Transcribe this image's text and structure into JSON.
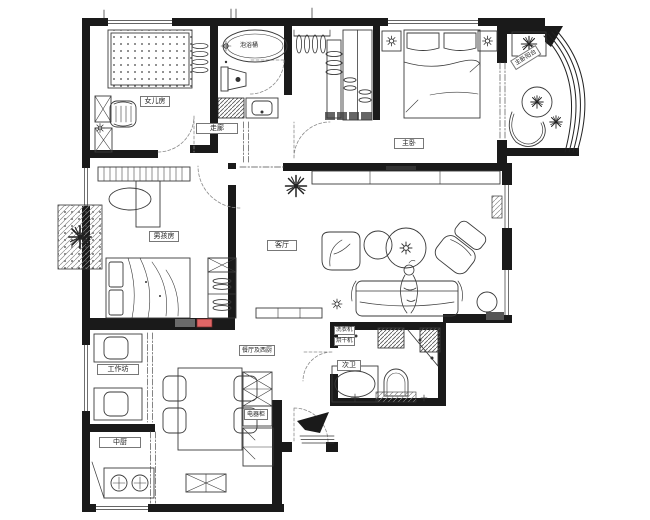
{
  "title": "apartment-floor-plan",
  "colors": {
    "wall": "#1a1a1a",
    "line": "#3a3a3a",
    "dash": "#8a8a8a",
    "accent_red": "#e06666",
    "shade_gray": "#6b6b6b",
    "paper": "#ffffff"
  },
  "rooms": {
    "daughter_room": {
      "label": "女儿房"
    },
    "master_bath": {
      "tub_label": "泡浴桶"
    },
    "corridor": {
      "label": "走廊"
    },
    "master_bedroom": {
      "label": "主卧"
    },
    "balcony": {
      "label": "主卧阳台"
    },
    "boy_room": {
      "label": "男孩房"
    },
    "living_room": {
      "label": "客厅"
    },
    "work_balcony": {
      "label": "工作坊"
    },
    "kitchen": {
      "label": "中厨"
    },
    "dining": {
      "label": "餐厅及西厨"
    },
    "appliance_cabinet": {
      "label": "电器柜"
    },
    "second_bath": {
      "label": "次卫",
      "washer_label": "洗衣机",
      "dryer_label": "烘干机"
    }
  }
}
